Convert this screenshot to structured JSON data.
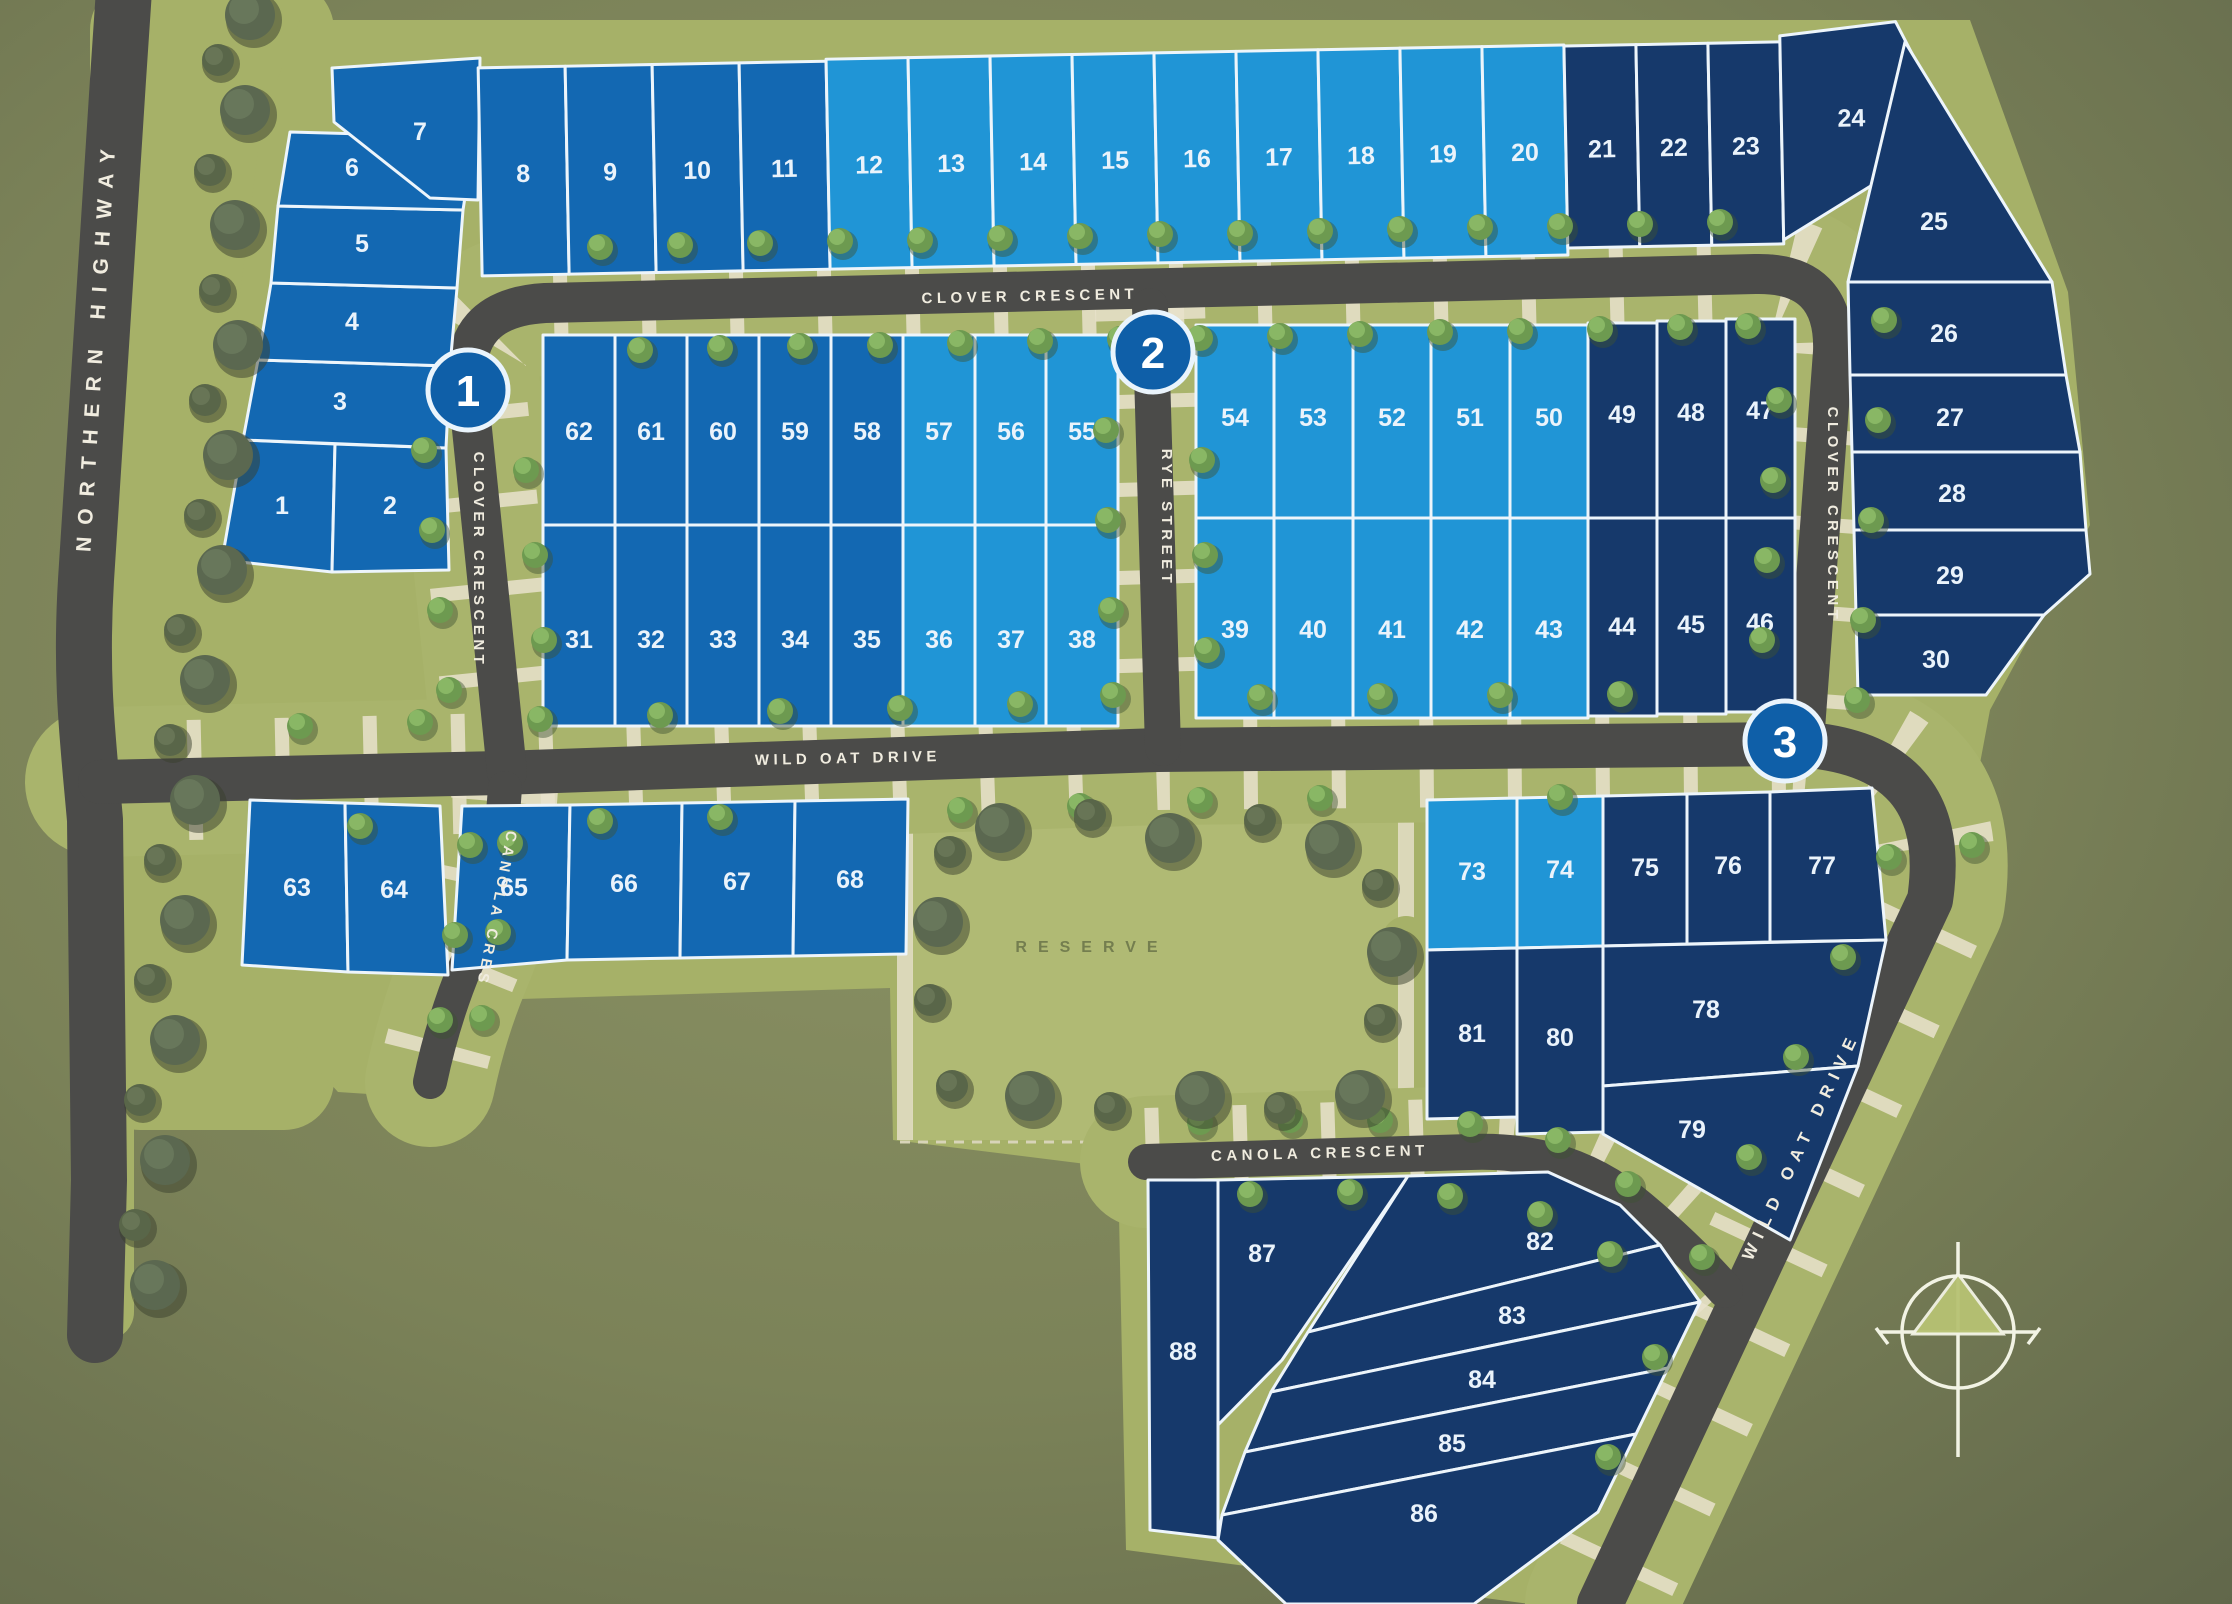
{
  "colors": {
    "stage1_color": "#1368b2",
    "stage2_color": "#2095d6",
    "stage3_color": "#16396b",
    "road_color": "#4b4b49",
    "verge_color": "#a9b46c",
    "sidewalk_color": "#e9e2cd",
    "background_color": "#78805a",
    "stage_marker_color": "#0f5fa8",
    "lot_border_color": "#edf5fb"
  },
  "streets": {
    "northern_highway": "NORTHERN HIGHWAY",
    "clover_crescent_top": "CLOVER CRESCENT",
    "clover_crescent_west": "CLOVER CRESCENT",
    "clover_crescent_east": "CLOVER CRESCENT",
    "rye_street": "RYE STREET",
    "wild_oat_drive": "WILD OAT DRIVE",
    "wild_oat_drive_diagonal": "WILD OAT DRIVE",
    "canola_cres": "CANOLA CRES",
    "canola_crescent": "CANOLA CRESCENT"
  },
  "reserve": {
    "label": "RESERVE"
  },
  "stage_markers": [
    {
      "label": "1"
    },
    {
      "label": "2"
    },
    {
      "label": "3"
    }
  ],
  "lots": {
    "l1": {
      "number": "1",
      "stage": 1
    },
    "l2": {
      "number": "2",
      "stage": 1
    },
    "l3": {
      "number": "3",
      "stage": 1
    },
    "l4": {
      "number": "4",
      "stage": 1
    },
    "l5": {
      "number": "5",
      "stage": 1
    },
    "l6": {
      "number": "6",
      "stage": 1
    },
    "l7": {
      "number": "7",
      "stage": 1
    },
    "l8": {
      "number": "8",
      "stage": 1
    },
    "l9": {
      "number": "9",
      "stage": 1
    },
    "l10": {
      "number": "10",
      "stage": 1
    },
    "l11": {
      "number": "11",
      "stage": 1
    },
    "l12": {
      "number": "12",
      "stage": 2
    },
    "l13": {
      "number": "13",
      "stage": 2
    },
    "l14": {
      "number": "14",
      "stage": 2
    },
    "l15": {
      "number": "15",
      "stage": 2
    },
    "l16": {
      "number": "16",
      "stage": 2
    },
    "l17": {
      "number": "17",
      "stage": 2
    },
    "l18": {
      "number": "18",
      "stage": 2
    },
    "l19": {
      "number": "19",
      "stage": 2
    },
    "l20": {
      "number": "20",
      "stage": 2
    },
    "l21": {
      "number": "21",
      "stage": 3
    },
    "l22": {
      "number": "22",
      "stage": 3
    },
    "l23": {
      "number": "23",
      "stage": 3
    },
    "l24": {
      "number": "24",
      "stage": 3
    },
    "l25": {
      "number": "25",
      "stage": 3
    },
    "l26": {
      "number": "26",
      "stage": 3
    },
    "l27": {
      "number": "27",
      "stage": 3
    },
    "l28": {
      "number": "28",
      "stage": 3
    },
    "l29": {
      "number": "29",
      "stage": 3
    },
    "l30": {
      "number": "30",
      "stage": 3
    },
    "l31": {
      "number": "31",
      "stage": 1
    },
    "l32": {
      "number": "32",
      "stage": 1
    },
    "l33": {
      "number": "33",
      "stage": 1
    },
    "l34": {
      "number": "34",
      "stage": 1
    },
    "l35": {
      "number": "35",
      "stage": 1
    },
    "l36": {
      "number": "36",
      "stage": 2
    },
    "l37": {
      "number": "37",
      "stage": 2
    },
    "l38": {
      "number": "38",
      "stage": 2
    },
    "l39": {
      "number": "39",
      "stage": 2
    },
    "l40": {
      "number": "40",
      "stage": 2
    },
    "l41": {
      "number": "41",
      "stage": 2
    },
    "l42": {
      "number": "42",
      "stage": 2
    },
    "l43": {
      "number": "43",
      "stage": 2
    },
    "l44": {
      "number": "44",
      "stage": 3
    },
    "l45": {
      "number": "45",
      "stage": 3
    },
    "l46": {
      "number": "46",
      "stage": 3
    },
    "l47": {
      "number": "47",
      "stage": 3
    },
    "l48": {
      "number": "48",
      "stage": 3
    },
    "l49": {
      "number": "49",
      "stage": 3
    },
    "l50": {
      "number": "50",
      "stage": 2
    },
    "l51": {
      "number": "51",
      "stage": 2
    },
    "l52": {
      "number": "52",
      "stage": 2
    },
    "l53": {
      "number": "53",
      "stage": 2
    },
    "l54": {
      "number": "54",
      "stage": 2
    },
    "l55": {
      "number": "55",
      "stage": 2
    },
    "l56": {
      "number": "56",
      "stage": 2
    },
    "l57": {
      "number": "57",
      "stage": 2
    },
    "l58": {
      "number": "58",
      "stage": 1
    },
    "l59": {
      "number": "59",
      "stage": 1
    },
    "l60": {
      "number": "60",
      "stage": 1
    },
    "l61": {
      "number": "61",
      "stage": 1
    },
    "l62": {
      "number": "62",
      "stage": 1
    },
    "l63": {
      "number": "63",
      "stage": 1
    },
    "l64": {
      "number": "64",
      "stage": 1
    },
    "l65": {
      "number": "65",
      "stage": 1
    },
    "l66": {
      "number": "66",
      "stage": 1
    },
    "l67": {
      "number": "67",
      "stage": 1
    },
    "l68": {
      "number": "68",
      "stage": 1
    },
    "l73": {
      "number": "73",
      "stage": 2
    },
    "l74": {
      "number": "74",
      "stage": 2
    },
    "l75": {
      "number": "75",
      "stage": 3
    },
    "l76": {
      "number": "76",
      "stage": 3
    },
    "l77": {
      "number": "77",
      "stage": 3
    },
    "l78": {
      "number": "78",
      "stage": 3
    },
    "l79": {
      "number": "79",
      "stage": 3
    },
    "l80": {
      "number": "80",
      "stage": 3
    },
    "l81": {
      "number": "81",
      "stage": 3
    },
    "l82": {
      "number": "82",
      "stage": 3
    },
    "l83": {
      "number": "83",
      "stage": 3
    },
    "l84": {
      "number": "84",
      "stage": 3
    },
    "l85": {
      "number": "85",
      "stage": 3
    },
    "l86": {
      "number": "86",
      "stage": 3
    },
    "l87": {
      "number": "87",
      "stage": 3
    },
    "l88": {
      "number": "88",
      "stage": 3
    }
  }
}
